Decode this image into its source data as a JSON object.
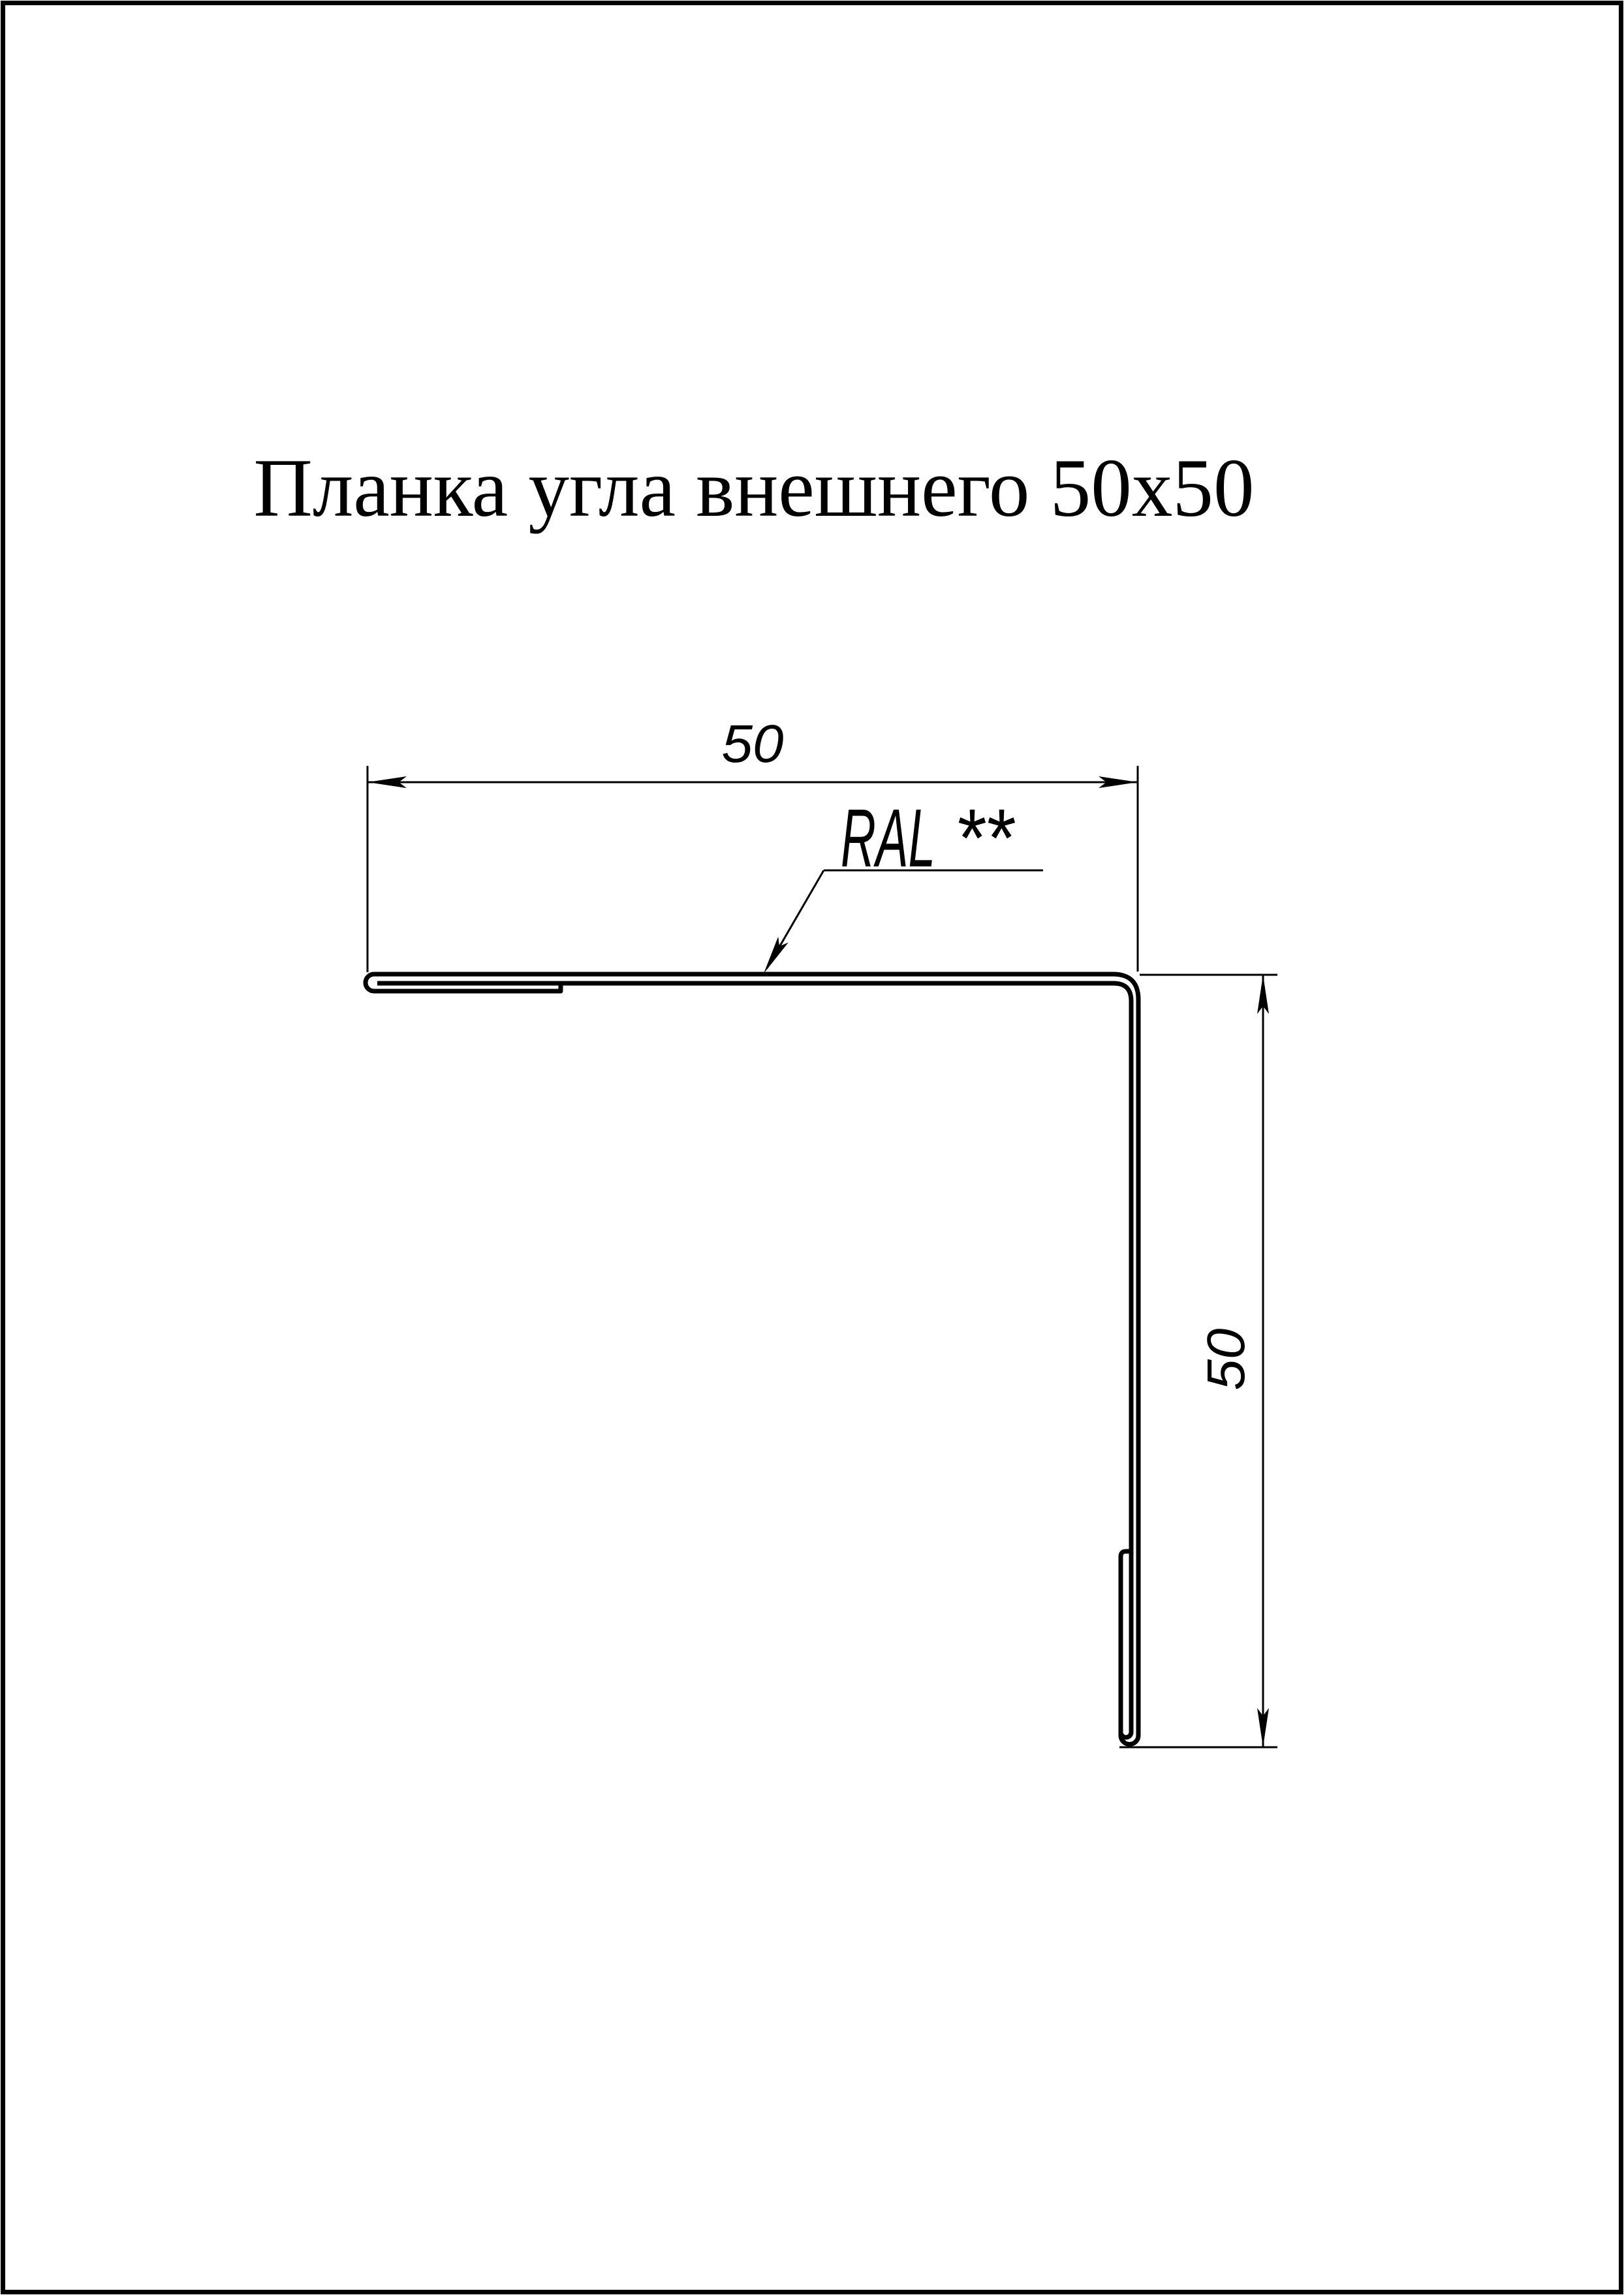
{
  "document": {
    "title": "Планка угла внешнего 50x50"
  },
  "dimensions": {
    "width_label": "50",
    "height_label": "50"
  },
  "callout": {
    "label": "RAL",
    "stars": "**"
  },
  "colors": {
    "ink": "#000000",
    "paper": "#ffffff"
  }
}
